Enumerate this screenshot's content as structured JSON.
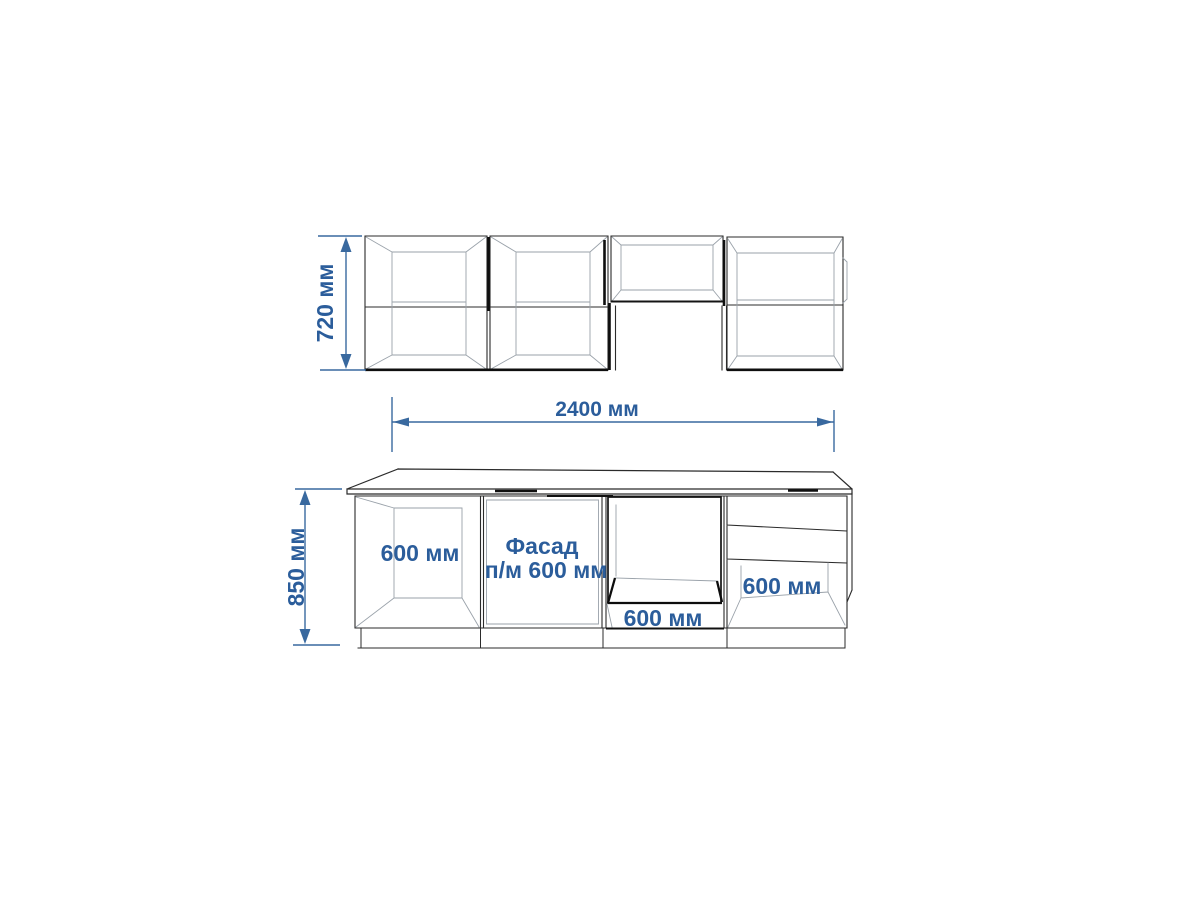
{
  "drawing": {
    "type": "kitchen-set-elevation",
    "units": "мм",
    "colors": {
      "background": "#ffffff",
      "line": "#2b2b2b",
      "dimension_line": "#39699f",
      "dimension_text": "#2b5d9b"
    },
    "dimension_labels": {
      "wall_height": "720 мм",
      "total_width": "2400 мм",
      "base_height": "850 мм"
    },
    "cabinet_labels": {
      "base_open": "600 мм",
      "facade_line1": "Фасад",
      "facade_line2": "п/м 600 мм",
      "oven": "600 мм",
      "drawers": "600 мм"
    }
  }
}
